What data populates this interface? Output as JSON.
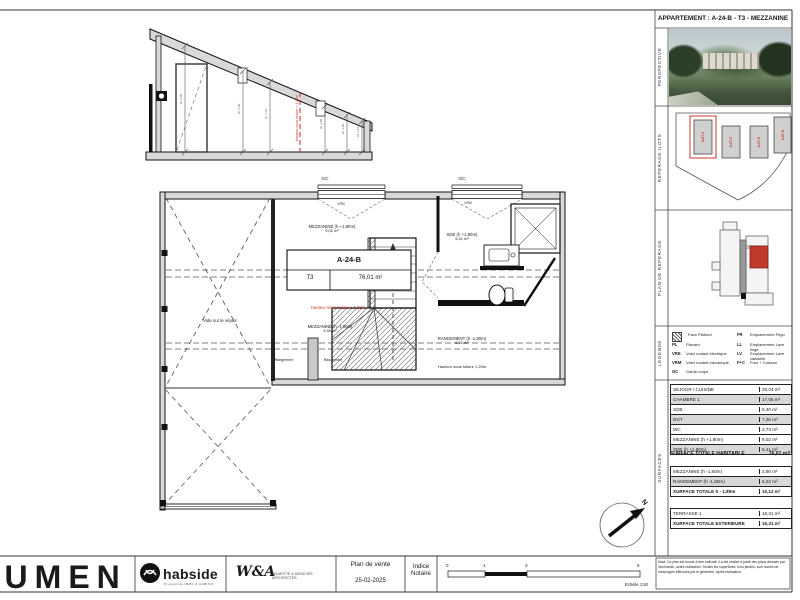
{
  "header": {
    "title": "APPARTEMENT :  A-24-B - T3 - MEZZANINE"
  },
  "panel": {
    "labels": {
      "perspective": "PERSPECTIVE",
      "ilots": "REPERAGE ILOTS",
      "reperage": "PLAN DE REPERAGE",
      "legende": "LEGENDE",
      "surfaces": "SURFACES"
    },
    "ilots": {
      "a": "ILOT A",
      "b": "ILOT B",
      "c": "ILOT C",
      "d": "ILOT D"
    },
    "legend": {
      "hatch_label": "Faux Plafond",
      "pl_key": "PL",
      "pl_label": "Placard",
      "vre_key": "VRE",
      "vre_label": "Volet roulant électrique",
      "vrm_key": "VRM",
      "vrm_label": "Volet roulant mécanique",
      "gc_key": "GC",
      "gc_label": "Garde-corps",
      "fr_key": "FR",
      "fr_label": "Emplacement Frigo",
      "ll_key": "LL",
      "ll_label": "Emplacement Lave linge",
      "lv_key": "LV",
      "lv_label": "Emplacement Lave vaisselle",
      "fc_key": "F+C",
      "fc_label": "Four + Cuisson"
    },
    "surfaces": {
      "t1": {
        "rows": [
          {
            "label": "SEJOUR / CUISINE",
            "value": "29,04 m²"
          },
          {
            "label": "CHAMBRE 1",
            "value": "17,05 m²"
          },
          {
            "label": "SDB",
            "value": "5,40 m²"
          },
          {
            "label": "DGT",
            "value": "7,36 m²"
          },
          {
            "label": "WC",
            "value": "2,73 m²"
          },
          {
            "label": "MEZZANINE (h +1,80m)",
            "value": "9,02 m²"
          },
          {
            "label": "SDE (h +1,80m)",
            "value": "5,41 m²"
          }
        ],
        "total_label": "SURFACE TOTALE HABITABLE",
        "total_value": "76,01 m2"
      },
      "t2": {
        "rows": [
          {
            "label": "MEZZANINE (h -1,80m)",
            "value": "3,90 m²"
          },
          {
            "label": "RANGEMENT (h -1,80m)",
            "value": "6,22 m²"
          }
        ],
        "total_label": "SURFACE TOTALE h - 1.80m",
        "total_value": "10,12 m²"
      },
      "t3": {
        "rows": [
          {
            "label": "TERRASSE 1",
            "value": "16,31 m²"
          }
        ],
        "total_label": "SURFACE TOTALE EXTERIEURE",
        "total_value": "16,31 m²"
      }
    }
  },
  "plan": {
    "unit": {
      "code": "A-24-B",
      "type": "T3",
      "area": "76,01 m²"
    },
    "rooms": {
      "mezzanine_high": {
        "name": "MEZZANINE (h +1,80m)",
        "area": "9,02 m²"
      },
      "mezzanine_low": {
        "name": "MEZZANINE (h -1,80m)",
        "area": "3,90 m²"
      },
      "sde": {
        "name": "SDE (h +1,80m)",
        "area": "5,41 m²"
      },
      "rangement": {
        "name": "RANGEMENT (h -1,80m)",
        "area": "6,22 m²"
      }
    },
    "notes": {
      "hauteur_red": "Hauteur sous toiture + 1,20m",
      "hauteur_black": "Hauteur sous toiture 1,20m",
      "vide": "Vide sur le séjour",
      "rangement_small": "Rangement"
    },
    "annotations": {
      "gc": "GC",
      "vrm": "VRM",
      "north": "N"
    }
  },
  "section": {
    "red_note": "Hauteur sous toiture + 1,20m",
    "dims": [
      "Ht. 2,60",
      "Ht. 1,90",
      "Ht. 1,70",
      "Ht. 1,50",
      "Ht. 1,20",
      "Ht. 1,10"
    ]
  },
  "footer": {
    "brand": "LUMEN",
    "habside": {
      "name": "habside",
      "tagline": "Programme IMMO & HABITAT"
    },
    "architect": {
      "monogram": "W&A",
      "name": "WILMOTTE & ASSOCIÉS ARCHITECTES"
    },
    "doc_title": "Plan de vente",
    "doc_date": "25-02-2025",
    "indice_line1": "Indice",
    "indice_line2": "Notaire",
    "scale": {
      "ticks": [
        "0",
        "1",
        "3",
        "5"
      ],
      "label": "Echelle 1:50"
    },
    "nota": "Nota: Ce plan est donné à titre indicatif, il a été réalisé à partir des plans dressés par l'architecte, avant réalisation. Seules les superficies, hors jardins, sont issues de mesurages effectués par le géomètre, après réalisation."
  }
}
